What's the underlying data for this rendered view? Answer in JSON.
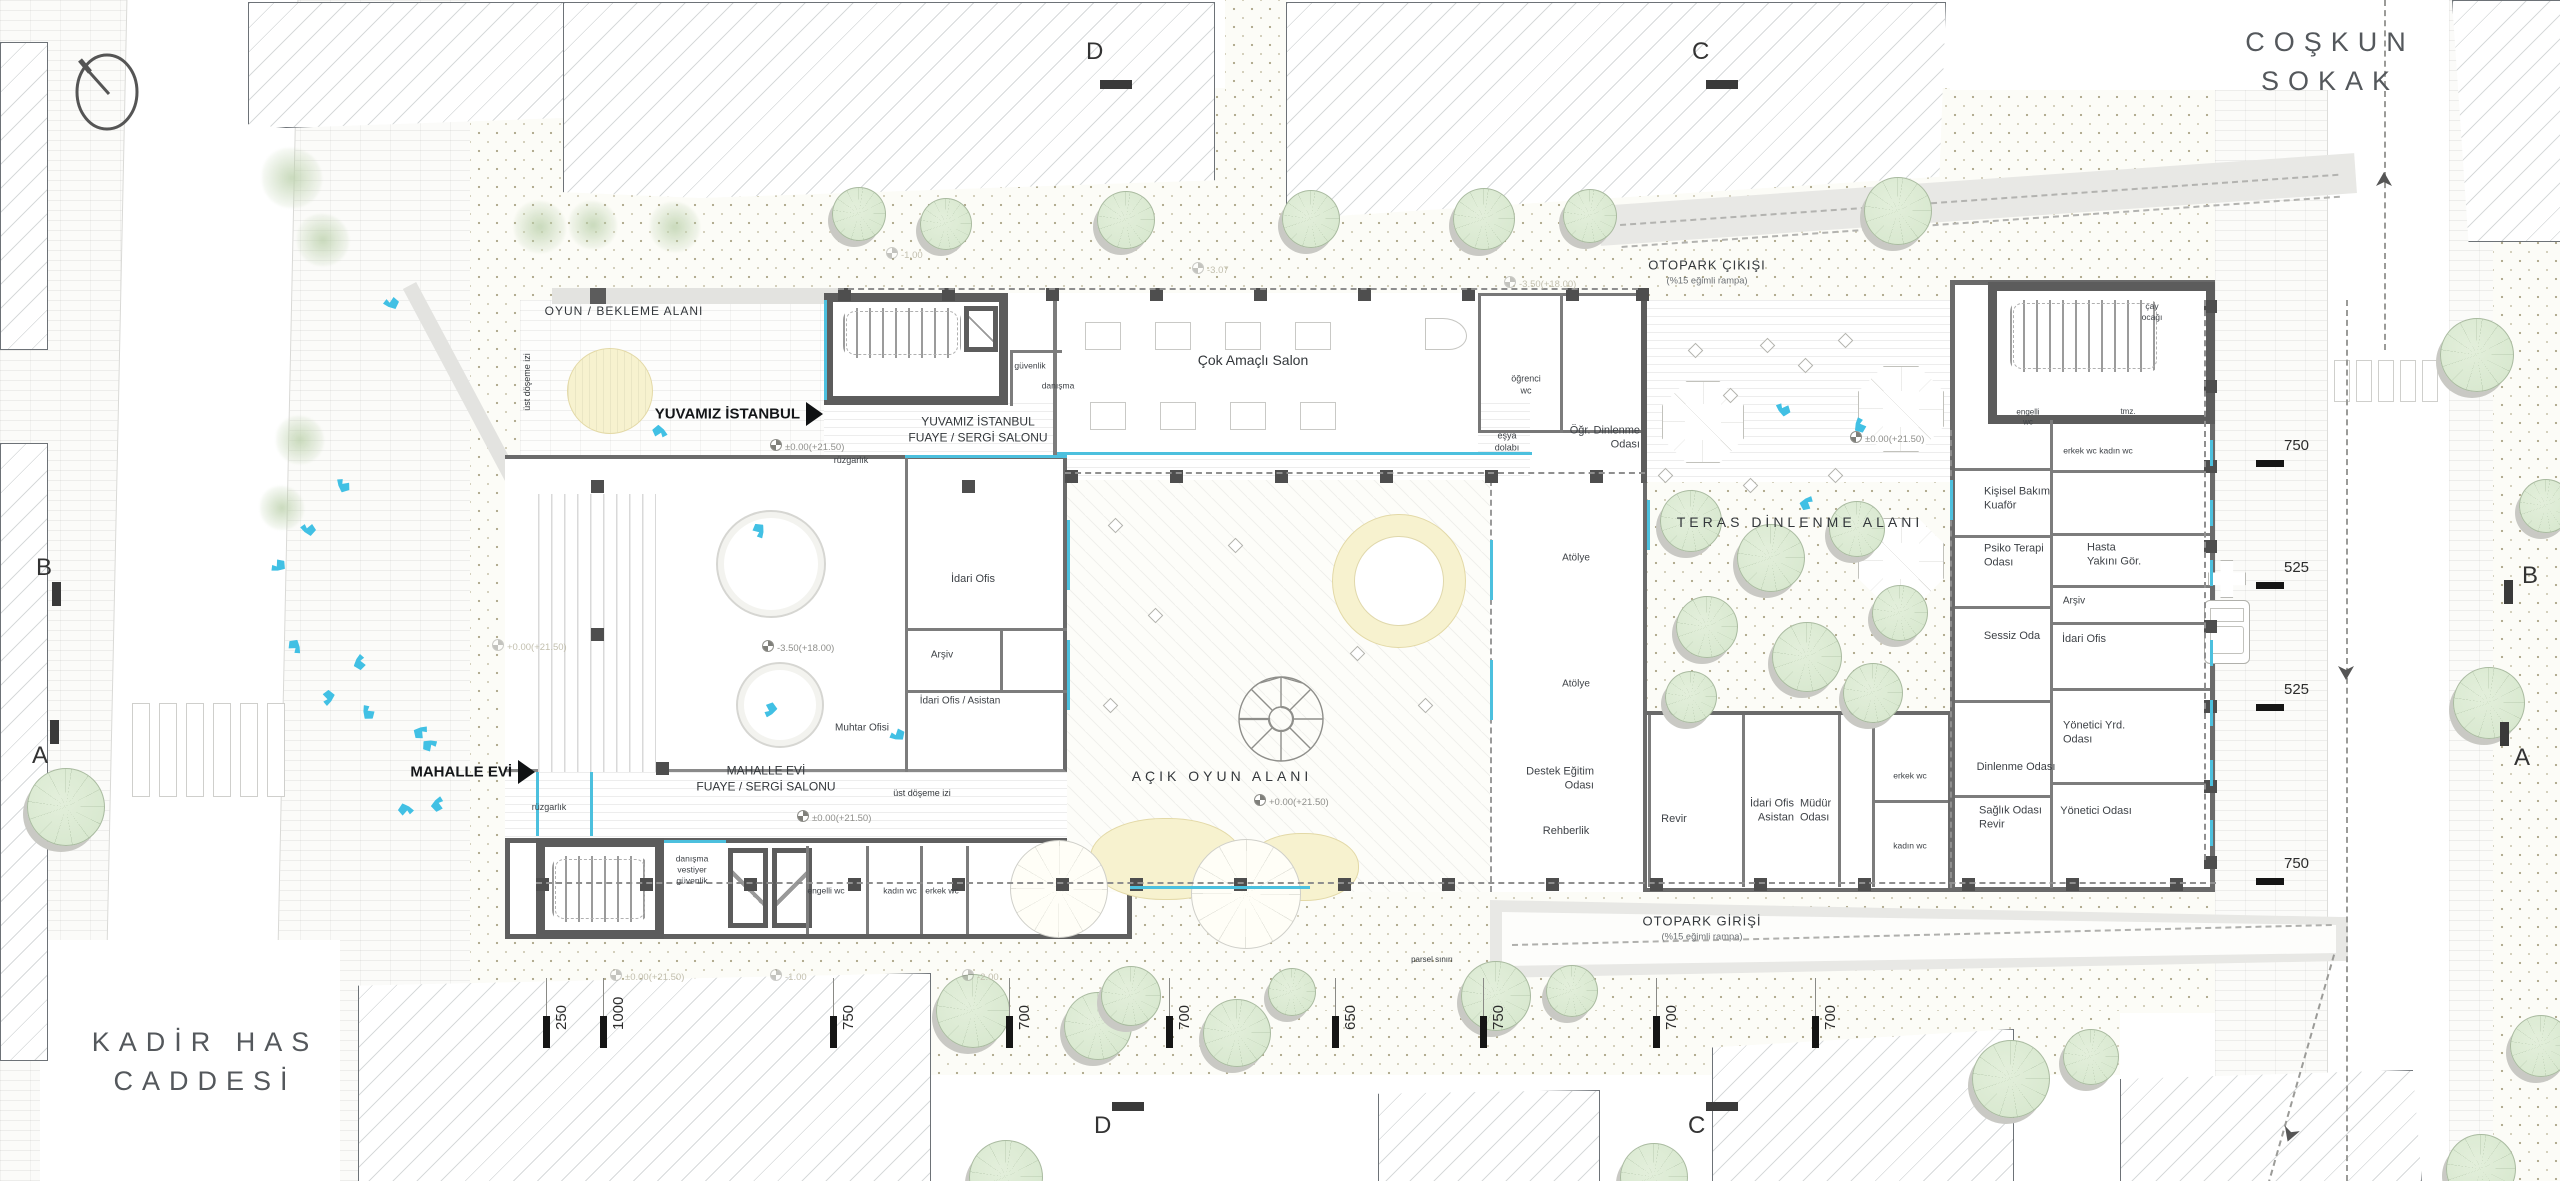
{
  "streets": [
    {
      "lines": [
        "COŞKUN",
        "SOKAK"
      ],
      "x": 2330,
      "y": 62
    },
    {
      "lines": [
        "KADİR HAS",
        "CADDESİ"
      ],
      "x": 205,
      "y": 1062
    }
  ],
  "entrances": [
    {
      "label": "YUVAMIZ İSTANBUL",
      "x": 806,
      "y": 414
    },
    {
      "label": "MAHALLE EVİ",
      "x": 518,
      "y": 772
    }
  ],
  "area_labels": [
    {
      "lines": [
        "OYUN / BEKLEME ALANI"
      ],
      "x": 624,
      "y": 312,
      "s": 12,
      "ls": 1
    },
    {
      "lines": [
        "TERAS DİNLENME ALANI"
      ],
      "x": 1800,
      "y": 522,
      "s": 14,
      "ls": 4
    },
    {
      "lines": [
        "AÇIK OYUN ALANI"
      ],
      "x": 1222,
      "y": 776,
      "s": 14,
      "ls": 4
    },
    {
      "lines": [
        "OTOPARK ÇIKIŞI"
      ],
      "x": 1707,
      "y": 272,
      "s": 13,
      "ls": 1,
      "sub": "(%15 eğimli rampa)"
    },
    {
      "lines": [
        "OTOPARK GİRİŞİ"
      ],
      "x": 1702,
      "y": 928,
      "s": 13,
      "ls": 1,
      "sub": "(%15 eğimli rampa)"
    },
    {
      "lines": [
        "YUVAMIZ İSTANBUL",
        "FUAYE / SERGİ SALONU"
      ],
      "x": 978,
      "y": 430,
      "s": 12,
      "ls": 0
    },
    {
      "lines": [
        "MAHALLE EVİ",
        "FUAYE / SERGİ SALONU"
      ],
      "x": 766,
      "y": 779,
      "s": 12,
      "ls": 0
    },
    {
      "lines": [
        "Çok Amaçlı Salon"
      ],
      "x": 1253,
      "y": 360,
      "s": 14,
      "ls": 0
    },
    {
      "lines": [
        "üst döşeme izi"
      ],
      "x": 528,
      "y": 382,
      "s": 9,
      "rot": -90
    },
    {
      "lines": [
        "üst döşeme izi"
      ],
      "x": 922,
      "y": 794,
      "s": 9
    },
    {
      "lines": [
        "parsel sınırı"
      ],
      "x": 1432,
      "y": 960,
      "s": 8,
      "col": "#a5a29a"
    }
  ],
  "room_labels": [
    {
      "lines": [
        "öğrenci",
        "wc"
      ],
      "x": 1526,
      "y": 385,
      "s": 9
    },
    {
      "lines": [
        "eşya",
        "dolabı"
      ],
      "x": 1507,
      "y": 442,
      "s": 9
    },
    {
      "lines": [
        "Öğr. Dinlenme",
        "Odası"
      ],
      "x": 1640,
      "y": 438,
      "s": 11,
      "al": "R"
    },
    {
      "lines": [
        "güvenlik"
      ],
      "x": 1030,
      "y": 366,
      "s": 8.5
    },
    {
      "lines": [
        "danışma"
      ],
      "x": 1058,
      "y": 386,
      "s": 8.5
    },
    {
      "lines": [
        "rüzgarlık"
      ],
      "x": 851,
      "y": 461,
      "s": 9
    },
    {
      "lines": [
        "rüzgarlık"
      ],
      "x": 549,
      "y": 808,
      "s": 9
    },
    {
      "lines": [
        "İdari Ofis"
      ],
      "x": 973,
      "y": 579,
      "s": 11
    },
    {
      "lines": [
        "Arşiv"
      ],
      "x": 942,
      "y": 655,
      "s": 10
    },
    {
      "lines": [
        "İdari Ofis / Asistan"
      ],
      "x": 960,
      "y": 701,
      "s": 10
    },
    {
      "lines": [
        "Muhtar Ofisi"
      ],
      "x": 862,
      "y": 728,
      "s": 10
    },
    {
      "lines": [
        "danışma",
        "vestiyer",
        "güvenlik"
      ],
      "x": 692,
      "y": 870,
      "s": 8.5
    },
    {
      "lines": [
        "engelli wc"
      ],
      "x": 826,
      "y": 891,
      "s": 8.5
    },
    {
      "lines": [
        "kadın wc"
      ],
      "x": 900,
      "y": 891,
      "s": 8.5
    },
    {
      "lines": [
        "erkek wc"
      ],
      "x": 942,
      "y": 891,
      "s": 8.5
    },
    {
      "lines": [
        "Atölye"
      ],
      "x": 1576,
      "y": 558,
      "s": 10
    },
    {
      "lines": [
        "Atölye"
      ],
      "x": 1576,
      "y": 684,
      "s": 10
    },
    {
      "lines": [
        "Destek Eğitim",
        "Odası"
      ],
      "x": 1594,
      "y": 779,
      "s": 11,
      "al": "R"
    },
    {
      "lines": [
        "Rehberlik"
      ],
      "x": 1566,
      "y": 831,
      "s": 11
    },
    {
      "lines": [
        "Revir"
      ],
      "x": 1674,
      "y": 819,
      "s": 11
    },
    {
      "lines": [
        "İdari Ofis",
        "Asistan"
      ],
      "x": 1794,
      "y": 811,
      "s": 11,
      "al": "R"
    },
    {
      "lines": [
        "Müdür",
        "Odası"
      ],
      "x": 1800,
      "y": 811,
      "s": 11,
      "al": "L"
    },
    {
      "lines": [
        "erkek wc"
      ],
      "x": 1910,
      "y": 776,
      "s": 8.5
    },
    {
      "lines": [
        "kadın wc"
      ],
      "x": 1910,
      "y": 846,
      "s": 8.5
    },
    {
      "lines": [
        "çay",
        "ocağı"
      ],
      "x": 2152,
      "y": 312,
      "s": 8.5
    },
    {
      "lines": [
        "engelli",
        "wc"
      ],
      "x": 2028,
      "y": 418,
      "s": 8
    },
    {
      "lines": [
        "tmz."
      ],
      "x": 2128,
      "y": 412,
      "s": 8
    },
    {
      "lines": [
        "erkek wc"
      ],
      "x": 2080,
      "y": 451,
      "s": 8.5
    },
    {
      "lines": [
        "kadın wc"
      ],
      "x": 2116,
      "y": 451,
      "s": 8.5
    },
    {
      "lines": [
        "Kişisel Bakım",
        "Kuaför"
      ],
      "x": 1984,
      "y": 499,
      "s": 11,
      "al": "L"
    },
    {
      "lines": [
        "Psiko Terapi",
        "Odası"
      ],
      "x": 1984,
      "y": 556,
      "s": 11,
      "al": "L"
    },
    {
      "lines": [
        "Hasta",
        "Yakını Gör."
      ],
      "x": 2087,
      "y": 555,
      "s": 11,
      "al": "L"
    },
    {
      "lines": [
        "Arşiv"
      ],
      "x": 2074,
      "y": 601,
      "s": 10
    },
    {
      "lines": [
        "Sessiz Oda"
      ],
      "x": 2012,
      "y": 636,
      "s": 11
    },
    {
      "lines": [
        "İdari Ofis"
      ],
      "x": 2084,
      "y": 639,
      "s": 11
    },
    {
      "lines": [
        "Yönetici Yrd.",
        "Odası"
      ],
      "x": 2063,
      "y": 733,
      "s": 11,
      "al": "L"
    },
    {
      "lines": [
        "Dinlenme Odası"
      ],
      "x": 2016,
      "y": 767,
      "s": 11
    },
    {
      "lines": [
        "Sağlık Odası",
        "Revir"
      ],
      "x": 1979,
      "y": 818,
      "s": 11,
      "al": "L"
    },
    {
      "lines": [
        "Yönetici Odası"
      ],
      "x": 2096,
      "y": 811,
      "s": 11
    }
  ],
  "elevation_marks": [
    {
      "text": "±0.00(+21.50)",
      "x": 770,
      "y": 445,
      "faded": false
    },
    {
      "text": "+0.00(+21.50)",
      "x": 492,
      "y": 645,
      "faded": true
    },
    {
      "text": "-3.50(+18.00)",
      "x": 762,
      "y": 646,
      "faded": false
    },
    {
      "text": "±0.00(+21.50)",
      "x": 1850,
      "y": 437,
      "faded": false
    },
    {
      "text": "+0.00(+21.50)",
      "x": 1254,
      "y": 800,
      "faded": false
    },
    {
      "text": "±0.00(+21.50)",
      "x": 797,
      "y": 816,
      "faded": false
    },
    {
      "text": "-3.50(+18.00)",
      "x": 1504,
      "y": 282,
      "faded": true
    },
    {
      "text": "±0.00(+21.50)",
      "x": 610,
      "y": 975,
      "faded": true
    },
    {
      "text": "-1.00",
      "x": 770,
      "y": 975,
      "faded": true
    },
    {
      "text": "-2.00",
      "x": 962,
      "y": 975,
      "faded": true
    },
    {
      "text": "-1.00",
      "x": 886,
      "y": 253,
      "faded": true
    },
    {
      "text": "-3.07",
      "x": 1192,
      "y": 268,
      "faded": true
    }
  ],
  "dimensions": {
    "right": [
      {
        "value": "750",
        "y": 446
      },
      {
        "value": "525",
        "y": 568
      },
      {
        "value": "525",
        "y": 690
      },
      {
        "value": "750",
        "y": 864
      }
    ],
    "bottom": [
      {
        "value": "250",
        "x": 543
      },
      {
        "value": "1000",
        "x": 600
      },
      {
        "value": "750",
        "x": 830
      },
      {
        "value": "700",
        "x": 1006
      },
      {
        "value": "700",
        "x": 1166
      },
      {
        "value": "650",
        "x": 1332
      },
      {
        "value": "750",
        "x": 1480
      },
      {
        "value": "700",
        "x": 1653
      },
      {
        "value": "700",
        "x": 1812
      }
    ]
  },
  "section_markers": [
    {
      "label": "D",
      "x": 1086,
      "y": 38,
      "bar": {
        "x": 1100,
        "y": 80,
        "w": 32,
        "h": 9
      }
    },
    {
      "label": "C",
      "x": 1692,
      "y": 38,
      "bar": {
        "x": 1706,
        "y": 80,
        "w": 32,
        "h": 9
      }
    },
    {
      "label": "D",
      "x": 1094,
      "y": 1112,
      "bar": {
        "x": 1112,
        "y": 1102,
        "w": 32,
        "h": 9
      }
    },
    {
      "label": "C",
      "x": 1688,
      "y": 1112,
      "bar": {
        "x": 1706,
        "y": 1102,
        "w": 32,
        "h": 9
      }
    },
    {
      "label": "B",
      "x": 36,
      "y": 554,
      "bar": {
        "x": 52,
        "y": 582,
        "w": 9,
        "h": 24
      }
    },
    {
      "label": "A",
      "x": 32,
      "y": 742,
      "bar": {
        "x": 50,
        "y": 720,
        "w": 9,
        "h": 24
      }
    },
    {
      "label": "B",
      "x": 2522,
      "y": 562,
      "bar": {
        "x": 2504,
        "y": 580,
        "w": 9,
        "h": 24
      }
    },
    {
      "label": "A",
      "x": 2514,
      "y": 744,
      "bar": {
        "x": 2500,
        "y": 722,
        "w": 9,
        "h": 24
      }
    }
  ],
  "compass": {
    "x": 70,
    "y": 78
  },
  "palette": {
    "wall": "#5c5c5c",
    "accent_cyan": "#4cc0de",
    "bird_blue": "#41c0e4",
    "tree_green": "#d5e6cc",
    "play_yellow": "#f7f2cf",
    "ramp_gray": "#e8e8e5"
  }
}
